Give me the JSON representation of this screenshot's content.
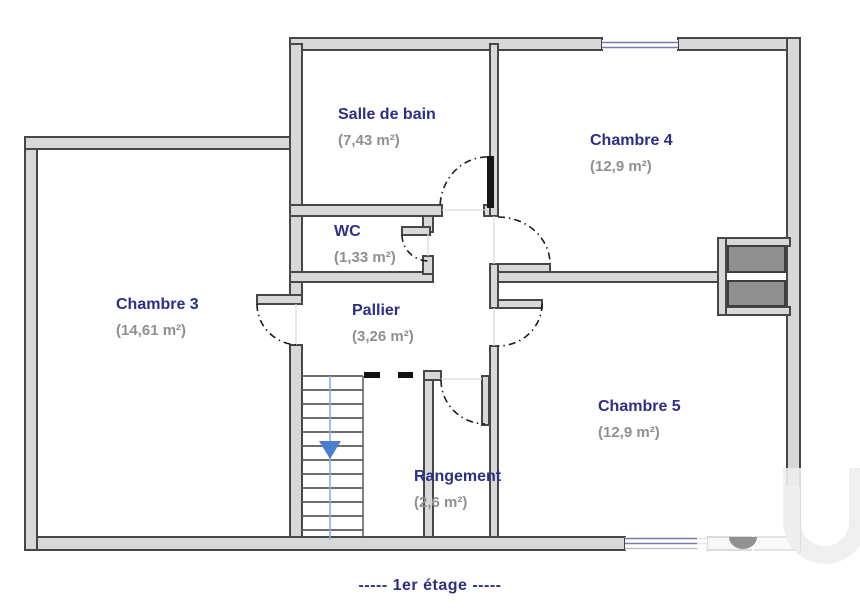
{
  "floor_plan": {
    "rooms": [
      {
        "id": "salle-de-bain",
        "name": "Salle de bain",
        "area": "(7,43 m²)"
      },
      {
        "id": "chambre-4",
        "name": "Chambre 4",
        "area": "(12,9 m²)"
      },
      {
        "id": "wc",
        "name": "WC",
        "area": "(1,33 m²)"
      },
      {
        "id": "chambre-3",
        "name": "Chambre 3",
        "area": "(14,61 m²)"
      },
      {
        "id": "pallier",
        "name": "Pallier",
        "area": "(3,26 m²)"
      },
      {
        "id": "chambre-5",
        "name": "Chambre 5",
        "area": "(12,9 m²)"
      },
      {
        "id": "rangement",
        "name": "Rangement",
        "area": "(2,6 m²)"
      }
    ],
    "footer": {
      "label": "-----  1er étage  -----"
    },
    "colors": {
      "room_name": "#2e2e85",
      "room_area": "#8f8f8f",
      "wall_fill": "#d8d8d8",
      "wall_stroke": "#474747",
      "window_line": "#7a7aa8",
      "stair_guide_line": "#88aee0",
      "stair_arrow": "#4a7fd0",
      "door_leaf_dark": "#151515",
      "shelf_fill": "#8f8f8f"
    },
    "icons": {
      "stairs_direction": "down-arrow"
    }
  }
}
